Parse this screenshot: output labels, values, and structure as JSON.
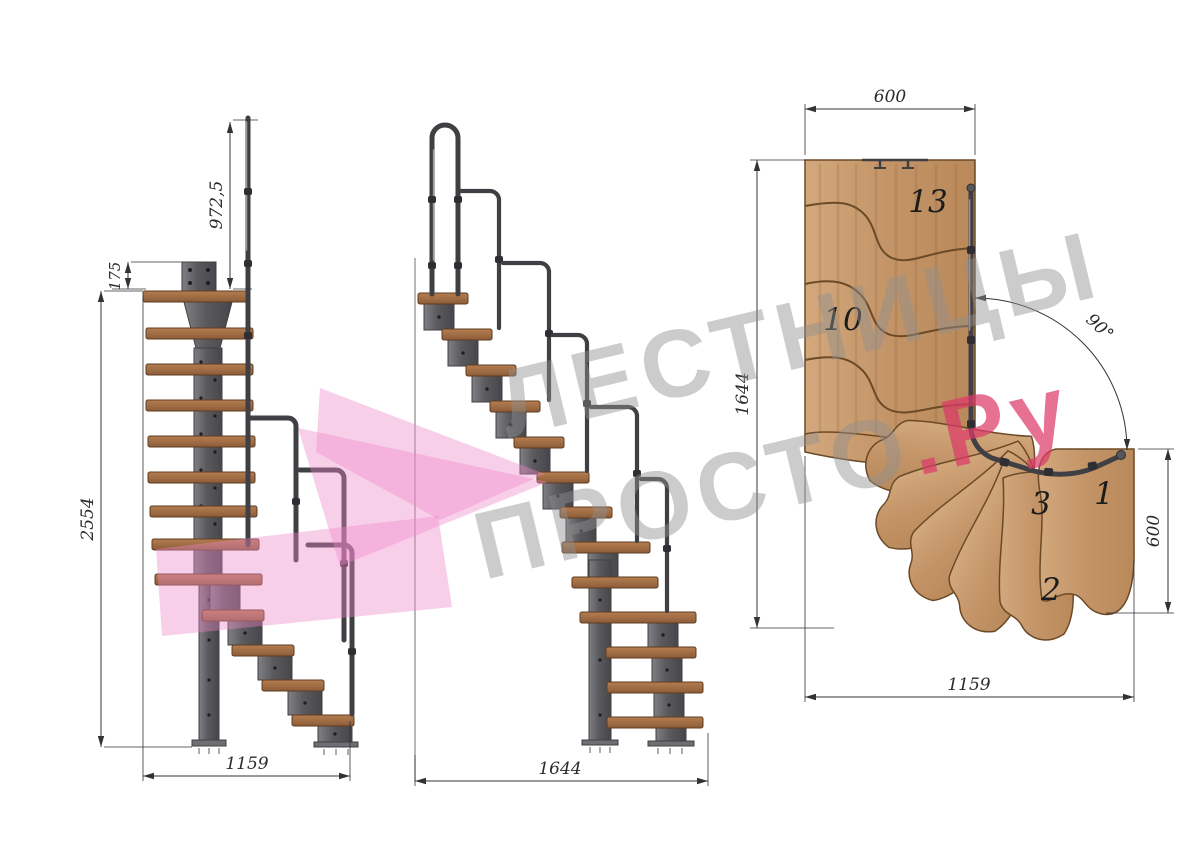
{
  "drawing": {
    "title": "modular-staircase-technical-drawing",
    "watermark": {
      "line1": "ЛЕСТНИЦЫ",
      "line2": "ПРОСТО",
      "suffix": ".Ру"
    },
    "side_view": {
      "dim_handrail_height": "972,5",
      "dim_bracket_offset": "175",
      "dim_total_height": "2554",
      "dim_run_length": "1159"
    },
    "front_view": {
      "dim_run_length": "1644"
    },
    "plan_view": {
      "dim_top_width": "600",
      "dim_left_length": "1644",
      "dim_turn_angle": "90°",
      "dim_right_width": "600",
      "dim_bottom_length": "1159",
      "steps": {
        "s13": "13",
        "s10": "10",
        "s3": "3",
        "s1": "1",
        "s2": "2"
      }
    },
    "colors": {
      "wood": "#c9a070",
      "wood_dark": "#8a5f36",
      "tread": "#a06c44",
      "metal": "#6a6a6e",
      "metal_dark": "#3f3f44",
      "dim": "#333333",
      "wm_gray": "#8f8f8f",
      "wm_pink": "#dc3a68",
      "logo_pink": "#ee86c8"
    }
  }
}
